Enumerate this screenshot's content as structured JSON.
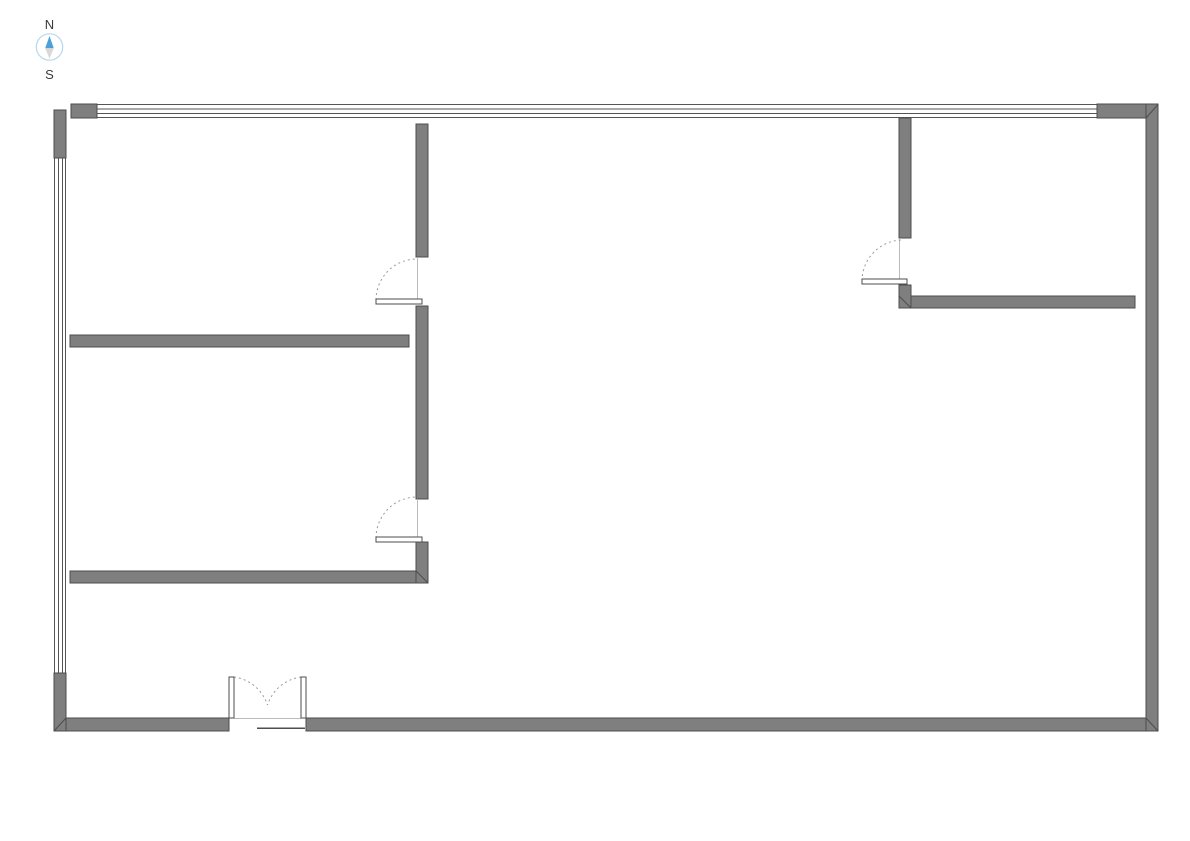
{
  "compass": {
    "north_label": "N",
    "south_label": "S"
  },
  "colors": {
    "background": "#ffffff",
    "wall_fill": "#7f7f7f",
    "wall_outline": "#4d4d4d",
    "line": "#555555",
    "door_arc": "#9a9a9a",
    "door_leaf_fill": "#ffffff",
    "opening_line": "#bbbbbb",
    "compass_text": "#3a3a3a",
    "compass_ring": "#b5d8ee",
    "compass_north": "#4aa0d9",
    "compass_south": "#d8d8d8"
  },
  "plan": {
    "type": "floor-plan",
    "exterior_walls": [
      "top",
      "right",
      "bottom",
      "left"
    ],
    "windows": [
      {
        "name": "top-window-strip",
        "wall": "top",
        "glazing_lines": 4
      },
      {
        "name": "left-window-strip",
        "wall": "left",
        "glazing_lines": 4
      }
    ],
    "doors": [
      {
        "name": "upper-left-room-door",
        "type": "single",
        "swing": "dashed-arc"
      },
      {
        "name": "lower-left-room-door",
        "type": "single",
        "swing": "dashed-arc"
      },
      {
        "name": "right-room-door",
        "type": "single",
        "swing": "dashed-arc"
      },
      {
        "name": "entrance-double-door",
        "type": "double",
        "wall": "bottom",
        "swing": "dashed-arcs"
      }
    ],
    "rooms": [
      "upper-left-room",
      "lower-left-room",
      "main-hall",
      "right-room"
    ]
  }
}
